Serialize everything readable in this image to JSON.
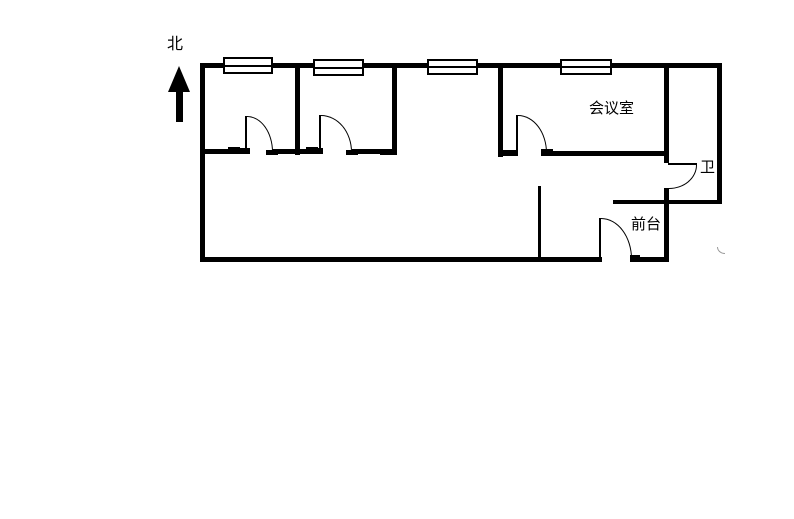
{
  "canvas": {
    "width": 794,
    "height": 519,
    "background": "#ffffff",
    "ink": "#000000"
  },
  "labels": {
    "north": "北",
    "meeting_room": "会议室",
    "toilet": "卫",
    "reception": "前台"
  },
  "floorplan": {
    "walls": [
      {
        "name": "wall-top",
        "x": 200,
        "y": 63,
        "w": 522,
        "h": 5
      },
      {
        "name": "wall-left",
        "x": 200,
        "y": 63,
        "w": 5,
        "h": 199
      },
      {
        "name": "wall-bottom-west",
        "x": 200,
        "y": 257,
        "w": 398,
        "h": 5
      },
      {
        "name": "wall-bottom-east",
        "x": 632,
        "y": 257,
        "w": 37,
        "h": 5
      },
      {
        "name": "wall-right",
        "x": 717,
        "y": 63,
        "w": 5,
        "h": 141
      },
      {
        "name": "wall-southeast-horizontal",
        "x": 613,
        "y": 200,
        "w": 109,
        "h": 4
      },
      {
        "name": "wall-toilet-west-upper",
        "x": 664,
        "y": 63,
        "w": 5,
        "h": 100
      },
      {
        "name": "wall-toilet-west-lower",
        "x": 664,
        "y": 188,
        "w": 5,
        "h": 74
      },
      {
        "name": "wall-corridor-seg1",
        "x": 200,
        "y": 149,
        "w": 40,
        "h": 5
      },
      {
        "name": "wall-corridor-seg2",
        "x": 272,
        "y": 149,
        "w": 46,
        "h": 5
      },
      {
        "name": "wall-corridor-seg3",
        "x": 352,
        "y": 149,
        "w": 45,
        "h": 5
      },
      {
        "name": "wall-divider-room1-room2",
        "x": 295,
        "y": 65,
        "w": 5,
        "h": 90
      },
      {
        "name": "wall-divider-room2-room3",
        "x": 392,
        "y": 65,
        "w": 5,
        "h": 88
      },
      {
        "name": "wall-divider-room2-room3-foot",
        "x": 380,
        "y": 150,
        "w": 17,
        "h": 5
      },
      {
        "name": "wall-meeting-west",
        "x": 498,
        "y": 65,
        "w": 5,
        "h": 92
      },
      {
        "name": "wall-meeting-south-stub",
        "x": 498,
        "y": 150,
        "w": 20,
        "h": 6
      },
      {
        "name": "wall-meeting-south",
        "x": 543,
        "y": 151,
        "w": 124,
        "h": 5
      },
      {
        "name": "jamb-room1-left",
        "x": 228,
        "y": 147,
        "w": 12,
        "h": 7
      },
      {
        "name": "jamb-room1-hinge",
        "x": 240,
        "y": 148,
        "w": 10,
        "h": 6
      },
      {
        "name": "jamb-room1-landing",
        "x": 266,
        "y": 150,
        "w": 12,
        "h": 5
      },
      {
        "name": "jamb-room2-left",
        "x": 306,
        "y": 147,
        "w": 12,
        "h": 7
      },
      {
        "name": "jamb-room2-hinge",
        "x": 312,
        "y": 148,
        "w": 11,
        "h": 6
      },
      {
        "name": "jamb-room2-landing",
        "x": 346,
        "y": 150,
        "w": 12,
        "h": 5
      },
      {
        "name": "jamb-meeting-landing",
        "x": 541,
        "y": 149,
        "w": 12,
        "h": 7
      },
      {
        "name": "jamb-main-door-hinge",
        "x": 594,
        "y": 257,
        "w": 8,
        "h": 5
      },
      {
        "name": "jamb-main-door-landing",
        "x": 630,
        "y": 255,
        "w": 10,
        "h": 7
      }
    ],
    "thin_lines": [
      {
        "name": "partition-reception",
        "x": 538,
        "y": 186,
        "w": 3,
        "h": 74
      },
      {
        "name": "door-leaf-room1",
        "x": 245,
        "y": 116,
        "w": 2,
        "h": 36
      },
      {
        "name": "door-leaf-room2",
        "x": 319,
        "y": 115,
        "w": 2,
        "h": 38
      },
      {
        "name": "door-leaf-meeting",
        "x": 516,
        "y": 115,
        "w": 2,
        "h": 38
      },
      {
        "name": "door-leaf-toilet",
        "x": 668,
        "y": 163,
        "w": 29,
        "h": 2
      },
      {
        "name": "door-leaf-main",
        "x": 599,
        "y": 218,
        "w": 2,
        "h": 42
      }
    ],
    "windows": [
      {
        "name": "window-1",
        "x": 223,
        "y": 57,
        "w": 50,
        "h": 17
      },
      {
        "name": "window-2",
        "x": 313,
        "y": 59,
        "w": 51,
        "h": 17
      },
      {
        "name": "window-3",
        "x": 427,
        "y": 59,
        "w": 51,
        "h": 16
      },
      {
        "name": "window-4",
        "x": 560,
        "y": 59,
        "w": 52,
        "h": 16
      }
    ],
    "arcs": [
      {
        "name": "door-arc-room1",
        "x": 247,
        "y": 116,
        "w": 26,
        "h": 36,
        "corner": "tr"
      },
      {
        "name": "door-arc-room2",
        "x": 321,
        "y": 115,
        "w": 31,
        "h": 37,
        "corner": "tr"
      },
      {
        "name": "door-arc-meeting",
        "x": 518,
        "y": 115,
        "w": 29,
        "h": 38,
        "corner": "tr"
      },
      {
        "name": "door-arc-toilet",
        "x": 669,
        "y": 165,
        "w": 28,
        "h": 24,
        "corner": "br"
      },
      {
        "name": "door-arc-main",
        "x": 601,
        "y": 218,
        "w": 31,
        "h": 41,
        "corner": "tr"
      }
    ]
  }
}
